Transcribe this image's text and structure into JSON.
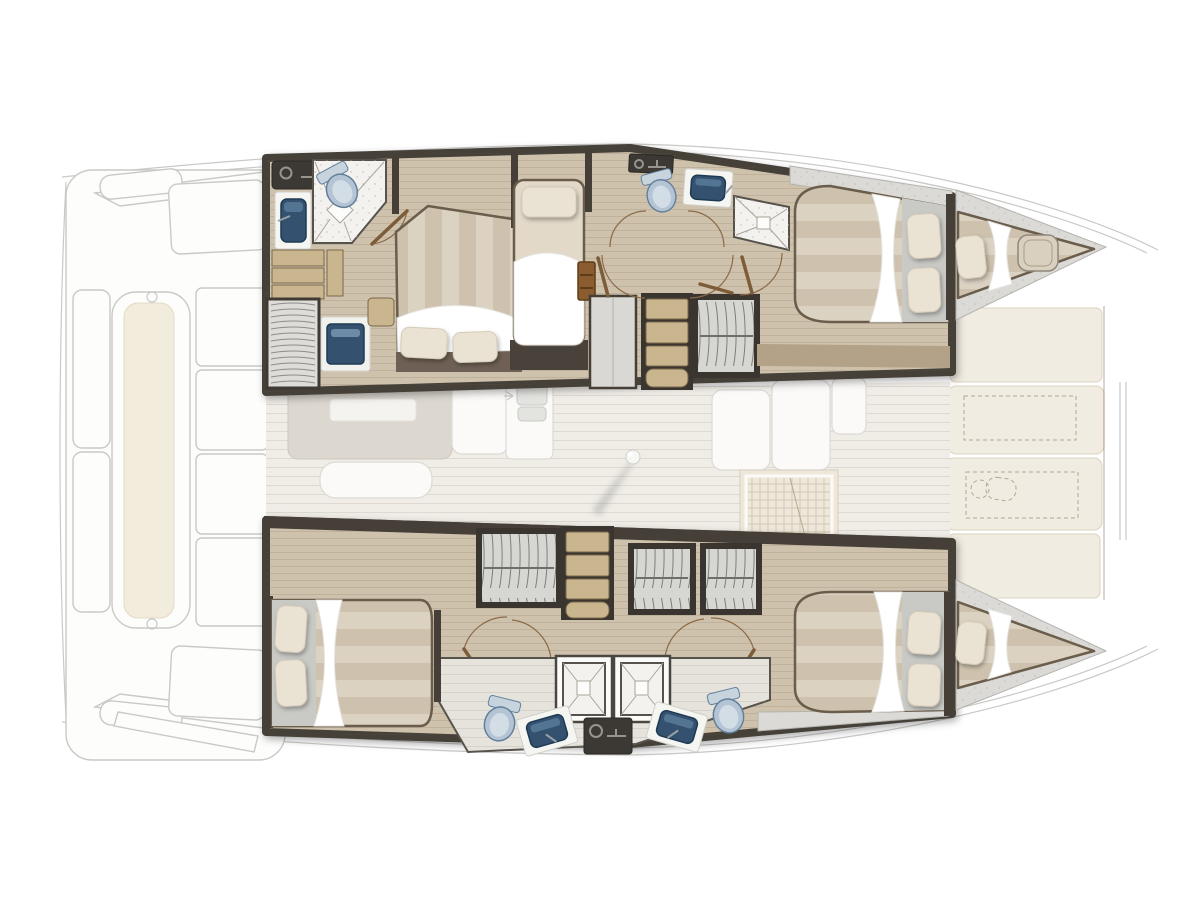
{
  "diagram": {
    "title": "Catamaran interior layout plan",
    "view": "top-down deck plan, bow to the right",
    "vessel_type": "sailing catamaran, 4 cabin / 4 head layout"
  },
  "colors": {
    "wall": "#453f38",
    "wall2": "#3a352f",
    "wood": "#cfc2ad",
    "woodDark": "#b3a288",
    "step": "#c9b68f",
    "stepEdge": "#7a6748",
    "m1": "#dbd2c2",
    "m2": "#cec2ae",
    "sheet": "#ffffff",
    "pillow": "#eae3d4",
    "pillowEdge": "#d5cbb7",
    "tile": "#f3f2ef",
    "tileLine": "#aaa49a",
    "toilet": "#b4c4d4",
    "toiletEdge": "#62809b",
    "toiletInner": "#d3dde6",
    "basin": "#345270",
    "basinEdge": "#1e3a53",
    "counter": "#f5f5f2",
    "counterEdge": "#d0d0cb",
    "wardrobe": "#d6d6d3",
    "granite": "#dbdad6",
    "graniteEdge": "#b4b3af",
    "ghostLine": "#c9c9c7",
    "ghostFill": "#fdfdfc",
    "ghostFurn": "#dcd8d0",
    "cream": "#f1ece1",
    "creamEdge": "#dbd3bf",
    "dash": "#b1a996",
    "darkUnit": "#3c3833",
    "bedFrame": "#6b5d4b",
    "door": "#8a6a48",
    "doorLeaf": "#7d5c38",
    "salonFloor": "#f0ede7",
    "maroon": "#8a5a50",
    "metal": "#9aa2a8"
  },
  "areas": {
    "aft_cockpit": {
      "state": "ghosted",
      "items": [
        "transom-steps",
        "aft-bench-cushion",
        "cockpit-seats",
        "swim-platform-steps"
      ]
    },
    "salon": {
      "state": "ghosted",
      "items": [
        "galley-island",
        "galley-bench",
        "double-sink-counter",
        "settee",
        "chart-table",
        "mast-post"
      ]
    },
    "port_hull": {
      "state": "detailed",
      "rooms": [
        {
          "name": "aft-head",
          "fixtures": [
            "countertop",
            "vanity-sink",
            "toilet",
            "shower",
            "washing-machine",
            "aft-staircase",
            "steps"
          ]
        },
        {
          "name": "aft-double-cabin",
          "fixtures": [
            "double-bed",
            "pillows"
          ]
        },
        {
          "name": "single-cabin",
          "fixtures": [
            "single-bed",
            "pillow",
            "step-ladder"
          ]
        },
        {
          "name": "companionway",
          "fixtures": [
            "stairs",
            "wardrobe",
            "cabinet",
            "door-swings"
          ]
        },
        {
          "name": "forward-head",
          "fixtures": [
            "countertop",
            "toilet",
            "sink",
            "shower"
          ]
        },
        {
          "name": "forward-double-cabin",
          "fixtures": [
            "double-bed",
            "pillows"
          ]
        },
        {
          "name": "forepeak-berth",
          "fixtures": [
            "mattress",
            "pillow",
            "deck-hatch"
          ]
        }
      ]
    },
    "starboard_hull": {
      "state": "detailed",
      "rooms": [
        {
          "name": "aft-double-cabin",
          "fixtures": [
            "double-bed",
            "pillows"
          ]
        },
        {
          "name": "companionway",
          "fixtures": [
            "stairs",
            "wardrobes",
            "door-swings"
          ]
        },
        {
          "name": "twin-heads",
          "fixtures": [
            "shower",
            "shower",
            "toilet",
            "toilet",
            "sink",
            "sink",
            "washing-machine"
          ]
        },
        {
          "name": "forward-double-cabin",
          "fixtures": [
            "double-bed",
            "pillows"
          ]
        },
        {
          "name": "forepeak-berth",
          "fixtures": [
            "mattress",
            "pillow"
          ]
        }
      ]
    },
    "foredeck": {
      "state": "ghosted",
      "items": [
        "sun-pad",
        "sun-pad",
        "windlass",
        "bowsprit"
      ]
    }
  }
}
